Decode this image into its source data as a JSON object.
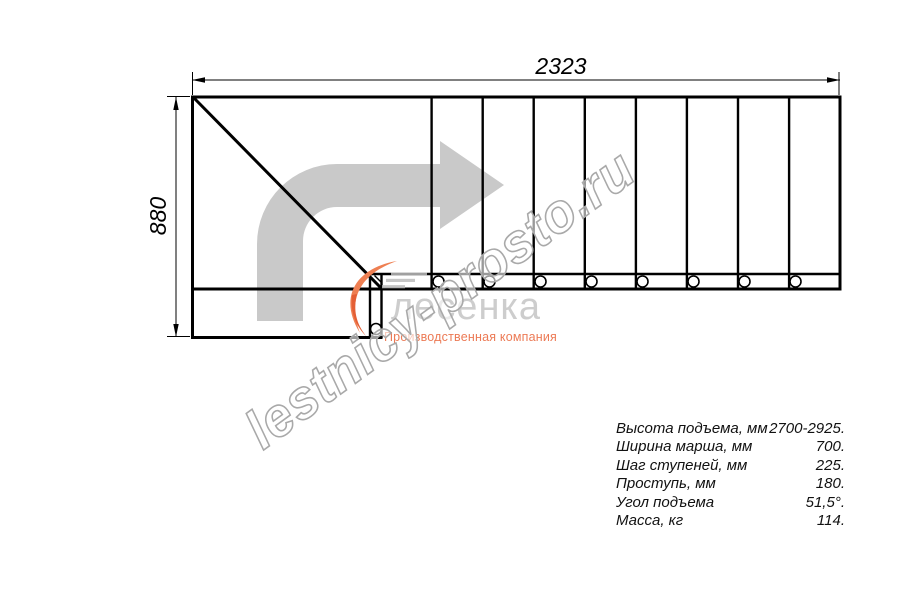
{
  "drawing": {
    "type_note": "staircase plan view, L-turn with winder steps",
    "dimensions": {
      "width_label": "2323",
      "height_label": "880"
    },
    "step_count_straight": 9,
    "mount_circle_count": 9
  },
  "specs": {
    "rows": [
      {
        "label": "Высота подъема, мм",
        "value": "2700-2925."
      },
      {
        "label": "Ширина марша, мм",
        "value": "700."
      },
      {
        "label": "Шаг ступеней, мм",
        "value": "225."
      },
      {
        "label": "Проступь, мм",
        "value": "180."
      },
      {
        "label": "Угол подъема",
        "value": "51,5°."
      },
      {
        "label": "Масса, кг",
        "value": "114."
      }
    ]
  },
  "watermark": {
    "site": "lestnicy-prosto.ru",
    "logo_text": "лесенка",
    "tagline": "Производственная компания"
  },
  "colors": {
    "line": "#000000",
    "arrow_gray": "#c9c9c9",
    "watermark_gray": "#a9a9a9",
    "logo_gray": "#c9c9c9",
    "logo_orange": "#ee7f52",
    "logo_orange_dark": "#e45f35",
    "tagline_color": "#ec7a55"
  }
}
